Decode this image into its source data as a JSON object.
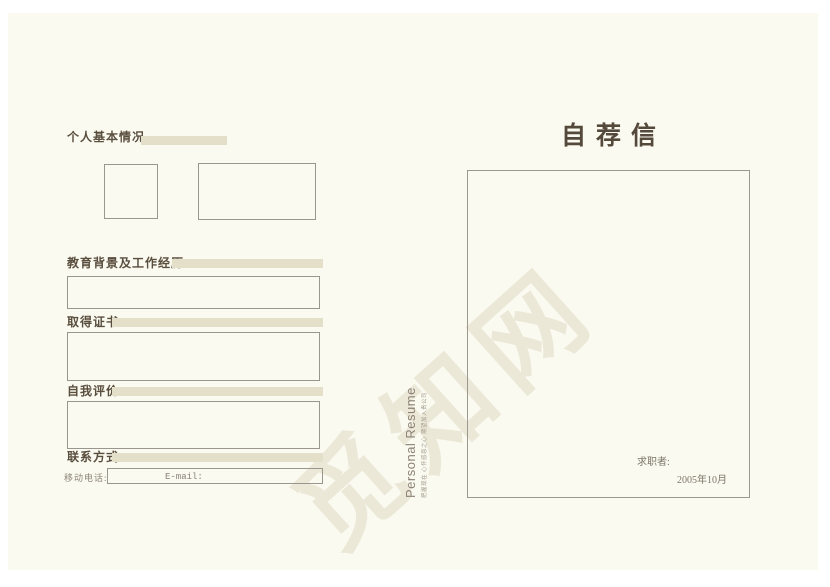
{
  "page": {
    "background_color": "#fafaf0",
    "accent_color": "#e4dfc8",
    "heading_color": "#5a4e3e",
    "watermark_text": "觅知网",
    "watermark_color": "#ece8d8"
  },
  "left_page": {
    "sections": {
      "basic_info": {
        "label": "个人基本情况"
      },
      "education": {
        "label": "教育背景及工作经历"
      },
      "certificates": {
        "label": "取得证书"
      },
      "self_evaluation": {
        "label": "自我评价"
      },
      "contact": {
        "label": "联系方式"
      }
    },
    "contact_fields": {
      "mobile_label": "移动电话:",
      "email_label": "E-mail:"
    }
  },
  "spine": {
    "title": "Personal Resume",
    "tagline": "把握现在 心怀感恩之心 期望加入贵公司"
  },
  "right_page": {
    "title": "自荐信",
    "signature_label": "求职者:",
    "date": "2005年10月"
  }
}
